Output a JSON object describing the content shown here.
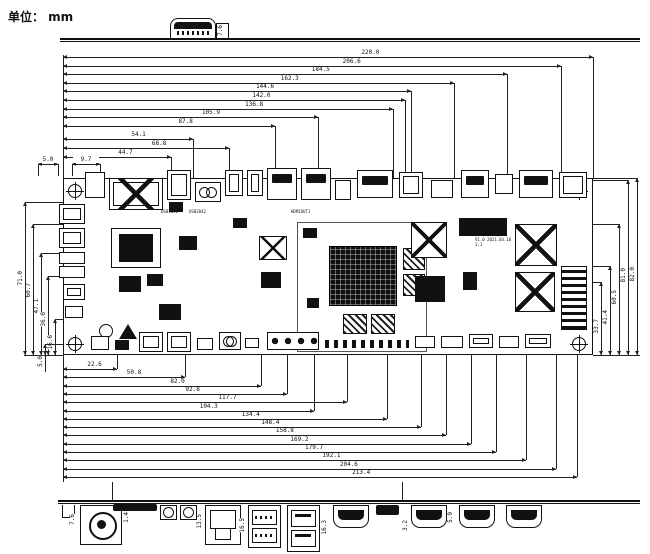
{
  "unit_label": "单位： mm",
  "dims": {
    "top": [
      "220.0",
      "206.6",
      "184.5",
      "162.3",
      "144.6",
      "142.0",
      "136.8",
      "105.9",
      "87.8",
      "54.1",
      "68.8",
      "44.7"
    ],
    "top_small": [
      "5.0",
      "9.7"
    ],
    "bottom": [
      "22.6",
      "50.8",
      "82.0",
      "92.8",
      "117.7",
      "104.3",
      "134.4",
      "148.4",
      "158.8",
      "169.2",
      "179.7",
      "192.1",
      "204.6",
      "213.4"
    ],
    "left": [
      "71.0",
      "60.7",
      "47.1",
      "36.6",
      "16.6"
    ],
    "left_small": [
      "5.0"
    ],
    "right": [
      "33.7",
      "41.4",
      "60.5",
      "81.0",
      "82.0"
    ],
    "port_dims": [
      "7.6",
      "1.4",
      "13.5",
      "16.5",
      "16.3",
      "3.2",
      "5.9"
    ],
    "top_view_dim": "7.6"
  },
  "board": {
    "width_mm": "220.0",
    "height_mm": "82.0",
    "labels": [
      "USB3041",
      "USB2042",
      "HDMIOUT1"
    ],
    "title_block": [
      "QC-HD8951_SAA",
      "V1.0 2021.03.16",
      "1:1"
    ]
  }
}
